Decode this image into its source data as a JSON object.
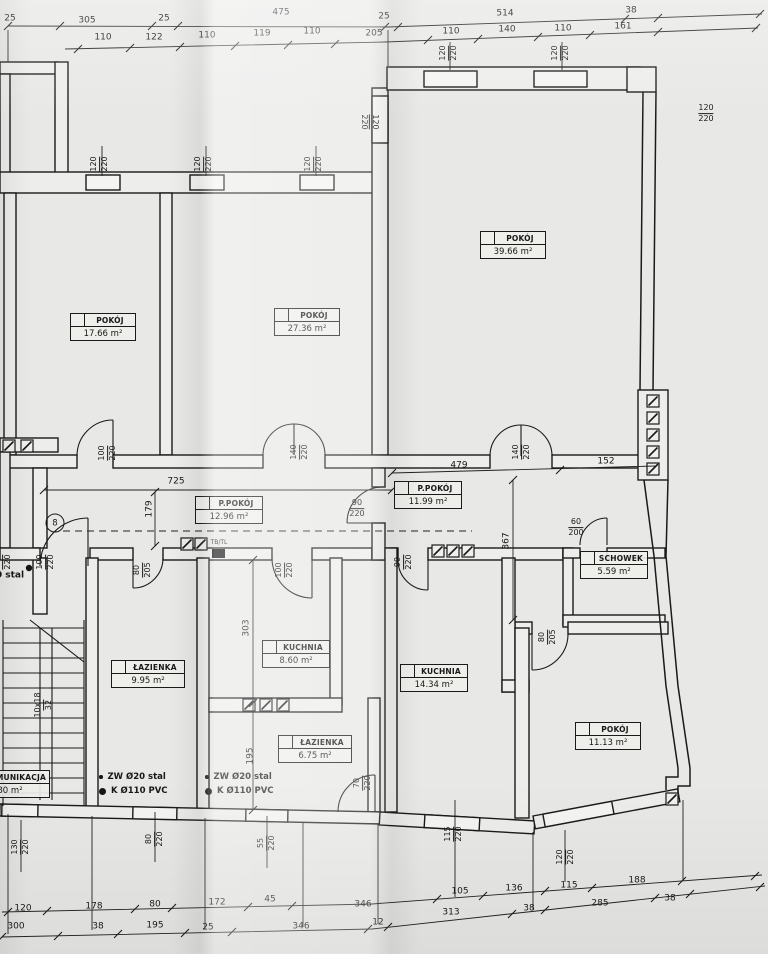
{
  "rooms": [
    {
      "name": "POKÓJ",
      "area": "17.66 m²",
      "x": 70,
      "y": 313,
      "w": 64
    },
    {
      "name": "POKÓJ",
      "area": "27.36 m²",
      "x": 274,
      "y": 308,
      "w": 64
    },
    {
      "name": "POKÓJ",
      "area": "39.66 m²",
      "x": 480,
      "y": 231,
      "w": 64
    },
    {
      "name": "P.POKÓJ",
      "area": "12.96 m²",
      "x": 195,
      "y": 496,
      "w": 66
    },
    {
      "name": "P.POKÓJ",
      "area": "11.99 m²",
      "x": 394,
      "y": 481,
      "w": 66
    },
    {
      "name": "SCHOWEK",
      "area": "5.59 m²",
      "x": 580,
      "y": 551,
      "w": 66
    },
    {
      "name": "KUCHNIA",
      "area": "8.60 m²",
      "x": 262,
      "y": 640,
      "w": 66
    },
    {
      "name": "KUCHNIA",
      "area": "14.34 m²",
      "x": 400,
      "y": 664,
      "w": 66
    },
    {
      "name": "ŁAZIENKA",
      "area": "9.95 m²",
      "x": 111,
      "y": 660,
      "w": 72
    },
    {
      "name": "ŁAZIENKA",
      "area": "6.75 m²",
      "x": 278,
      "y": 735,
      "w": 72
    },
    {
      "name": "POKÓJ",
      "area": "11.13 m²",
      "x": 575,
      "y": 722,
      "w": 64
    },
    {
      "name": "KOMUNIKACJA",
      "area": "80 m²",
      "x": -30,
      "y": 770,
      "w": 78
    }
  ],
  "labels": {
    "top_row_overall": [
      {
        "s": "25",
        "x": 10,
        "y": 19
      },
      {
        "s": "305",
        "x": 87,
        "y": 21
      },
      {
        "s": "25",
        "x": 164,
        "y": 19
      },
      {
        "s": "475",
        "x": 281,
        "y": 13
      },
      {
        "s": "25",
        "x": 384,
        "y": 17
      },
      {
        "s": "514",
        "x": 505,
        "y": 14
      },
      {
        "s": "38",
        "x": 631,
        "y": 11
      }
    ],
    "top_row_detail": [
      {
        "s": "110",
        "x": 103,
        "y": 38
      },
      {
        "s": "122",
        "x": 154,
        "y": 38
      },
      {
        "s": "110",
        "x": 207,
        "y": 36
      },
      {
        "s": "119",
        "x": 262,
        "y": 34
      },
      {
        "s": "110",
        "x": 312,
        "y": 32
      },
      {
        "s": "205",
        "x": 374,
        "y": 34
      },
      {
        "s": "110",
        "x": 451,
        "y": 32
      },
      {
        "s": "140",
        "x": 507,
        "y": 30
      },
      {
        "s": "110",
        "x": 563,
        "y": 29
      },
      {
        "s": "161",
        "x": 623,
        "y": 27
      }
    ],
    "bottom_row_detail": [
      {
        "s": "120",
        "x": 23,
        "y": 909
      },
      {
        "s": "178",
        "x": 94,
        "y": 907
      },
      {
        "s": "80",
        "x": 155,
        "y": 905
      },
      {
        "s": "172",
        "x": 217,
        "y": 903
      },
      {
        "s": "45",
        "x": 270,
        "y": 900
      },
      {
        "s": "346",
        "x": 363,
        "y": 905
      },
      {
        "s": "105",
        "x": 460,
        "y": 892
      },
      {
        "s": "136",
        "x": 514,
        "y": 889
      },
      {
        "s": "115",
        "x": 569,
        "y": 886
      },
      {
        "s": "188",
        "x": 637,
        "y": 881
      }
    ],
    "bottom_row_overall": [
      {
        "s": "300",
        "x": 16,
        "y": 927
      },
      {
        "s": "38",
        "x": 98,
        "y": 927
      },
      {
        "s": "195",
        "x": 155,
        "y": 926
      },
      {
        "s": "25",
        "x": 208,
        "y": 928
      },
      {
        "s": "346",
        "x": 301,
        "y": 927
      },
      {
        "s": "12",
        "x": 378,
        "y": 923
      },
      {
        "s": "313",
        "x": 451,
        "y": 913
      },
      {
        "s": "38",
        "x": 529,
        "y": 909
      },
      {
        "s": "285",
        "x": 600,
        "y": 904
      },
      {
        "s": "38",
        "x": 670,
        "y": 899
      }
    ],
    "interior_dims": [
      {
        "s": "725",
        "x": 176,
        "y": 482
      },
      {
        "s": "479",
        "x": 459,
        "y": 466
      },
      {
        "s": "152",
        "x": 606,
        "y": 462
      },
      {
        "s": "179",
        "x": 150,
        "y": 509,
        "r": -90
      },
      {
        "s": "367",
        "x": 507,
        "y": 541,
        "r": -90
      },
      {
        "s": "303",
        "x": 247,
        "y": 628,
        "r": -90
      },
      {
        "s": "195",
        "x": 251,
        "y": 756,
        "r": -90
      }
    ],
    "opening_sizes": [
      {
        "n": "120",
        "d": "220",
        "x": 100,
        "y": 164,
        "r": -90
      },
      {
        "n": "120",
        "d": "220",
        "x": 204,
        "y": 164,
        "r": -90
      },
      {
        "n": "120",
        "d": "220",
        "x": 314,
        "y": 164,
        "r": -90
      },
      {
        "n": "120",
        "d": "220",
        "x": 449,
        "y": 53,
        "r": -90
      },
      {
        "n": "120",
        "d": "220",
        "x": 561,
        "y": 53,
        "r": -90
      },
      {
        "n": "120",
        "d": "220",
        "x": 369,
        "y": 122,
        "r": 90
      },
      {
        "n": "120",
        "d": "220",
        "x": 706,
        "y": 114,
        "r": 0
      },
      {
        "n": "100",
        "d": "220",
        "x": 108,
        "y": 453,
        "r": -90
      },
      {
        "n": "140",
        "d": "220",
        "x": 300,
        "y": 452,
        "r": -90
      },
      {
        "n": "140",
        "d": "220",
        "x": 522,
        "y": 452,
        "r": -90
      },
      {
        "n": "90",
        "d": "220",
        "x": 357,
        "y": 509,
        "r": 0
      },
      {
        "n": "60",
        "d": "200",
        "x": 576,
        "y": 528,
        "r": 0
      },
      {
        "n": "100",
        "d": "220",
        "x": 3,
        "y": 562,
        "r": -90
      },
      {
        "n": "100",
        "d": "220",
        "x": 46,
        "y": 562,
        "r": -90
      },
      {
        "n": "80",
        "d": "205",
        "x": 143,
        "y": 570,
        "r": -90
      },
      {
        "n": "100",
        "d": "220",
        "x": 285,
        "y": 570,
        "r": -90
      },
      {
        "n": "90",
        "d": "220",
        "x": 404,
        "y": 562,
        "r": -90
      },
      {
        "n": "80",
        "d": "205",
        "x": 548,
        "y": 637,
        "r": -90
      },
      {
        "n": "70",
        "d": "220",
        "x": 363,
        "y": 783,
        "r": -90
      },
      {
        "n": "130",
        "d": "220",
        "x": 21,
        "y": 847,
        "r": -90
      },
      {
        "n": "80",
        "d": "220",
        "x": 155,
        "y": 839,
        "r": -90
      },
      {
        "n": "55",
        "d": "220",
        "x": 267,
        "y": 843,
        "r": -90
      },
      {
        "n": "115",
        "d": "220",
        "x": 454,
        "y": 834,
        "r": -90
      },
      {
        "n": "120",
        "d": "220",
        "x": 566,
        "y": 857,
        "r": -90
      }
    ],
    "notes": [
      {
        "s": "TB/TL",
        "x": 219,
        "y": 543,
        "fs": 6
      },
      {
        "s": "Ø50 stal",
        "x": 3,
        "y": 576,
        "a": "left",
        "b": 1
      },
      {
        "s": "8",
        "x": 55,
        "y": 523,
        "circ": 1
      }
    ],
    "stair_note": {
      "n": "10x18",
      "d": "32",
      "x": 44,
      "y": 705,
      "r": -90
    }
  },
  "legend": {
    "blocks": [
      {
        "x": 99,
        "y": 770
      },
      {
        "x": 205,
        "y": 770
      }
    ],
    "items": [
      {
        "bullet": "small",
        "text": "ZW Ø20 stal"
      },
      {
        "bullet": "large",
        "text": "K Ø110 PVC"
      }
    ]
  }
}
